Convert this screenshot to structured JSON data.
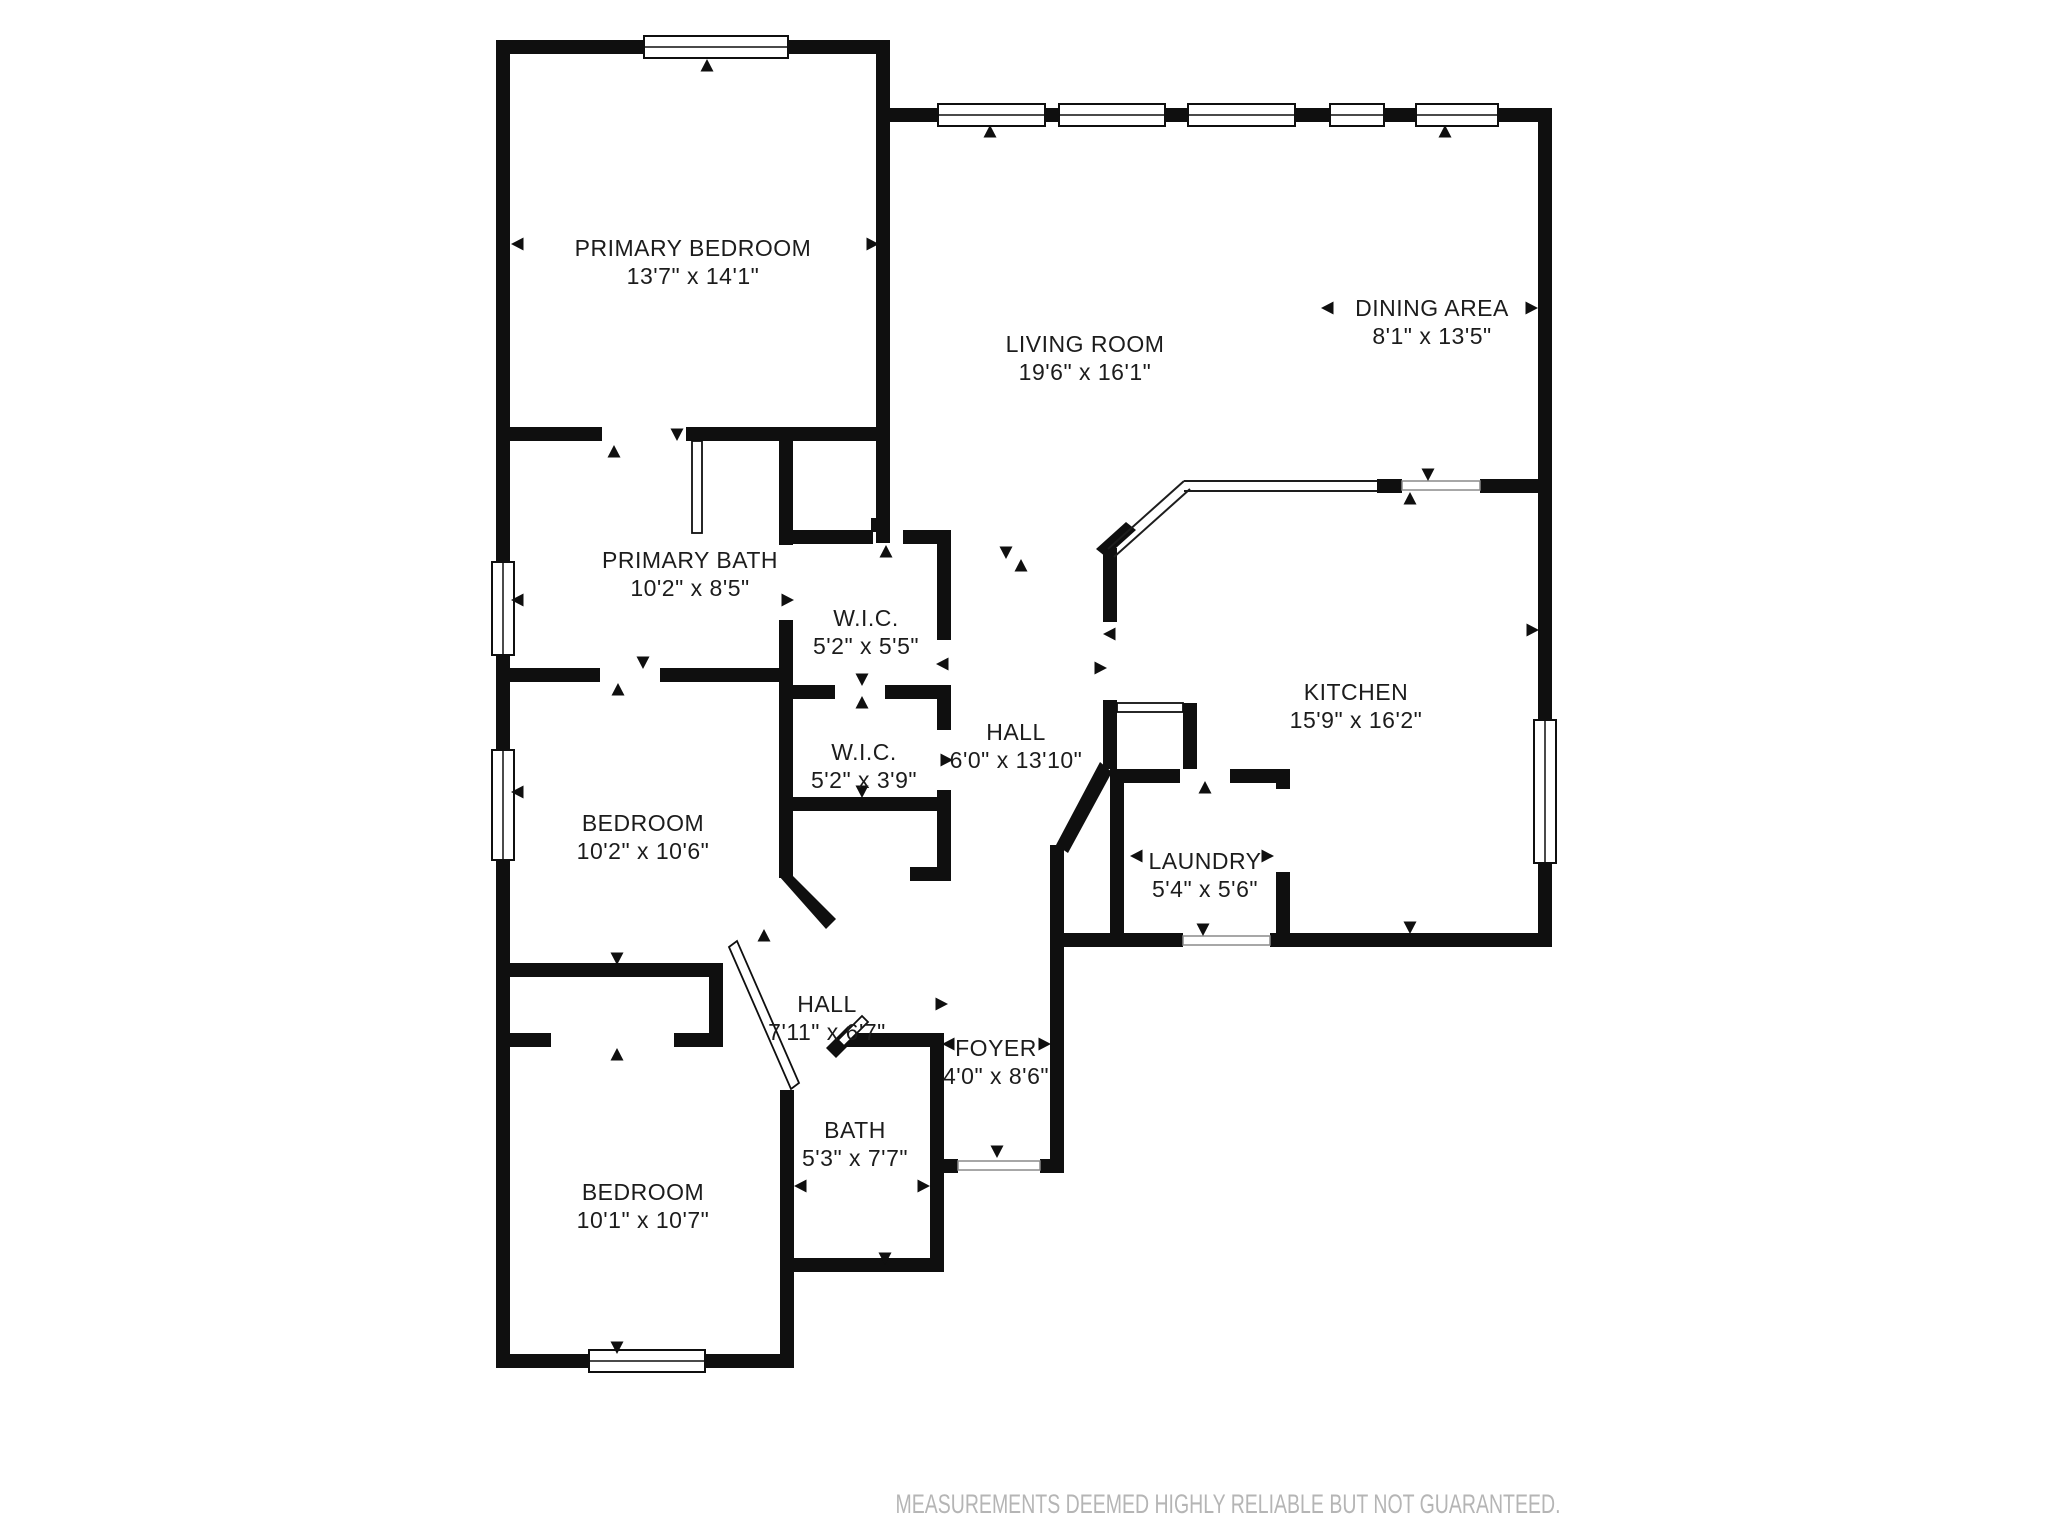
{
  "colors": {
    "wall": "#0f0f0f",
    "label": "#1c1c1c",
    "disclaimer": "#b5b5b5",
    "background": "#ffffff"
  },
  "rooms": [
    {
      "name": "PRIMARY BEDROOM",
      "dims": "13'7\" x 14'1\""
    },
    {
      "name": "LIVING ROOM",
      "dims": "19'6\" x 16'1\""
    },
    {
      "name": "DINING AREA",
      "dims": "8'1\" x 13'5\""
    },
    {
      "name": "PRIMARY BATH",
      "dims": "10'2\" x 8'5\""
    },
    {
      "name": "W.I.C.",
      "dims": "5'2\" x 5'5\""
    },
    {
      "name": "W.I.C.",
      "dims": "5'2\" x 3'9\""
    },
    {
      "name": "HALL",
      "dims": "6'0\" x 13'10\""
    },
    {
      "name": "KITCHEN",
      "dims": "15'9\" x 16'2\""
    },
    {
      "name": "LAUNDRY",
      "dims": "5'4\" x 5'6\""
    },
    {
      "name": "BEDROOM",
      "dims": "10'2\" x 10'6\""
    },
    {
      "name": "HALL",
      "dims": "7'11\" x 6'7\""
    },
    {
      "name": "FOYER",
      "dims": "4'0\" x 8'6\""
    },
    {
      "name": "BATH",
      "dims": "5'3\" x 7'7\""
    },
    {
      "name": "BEDROOM",
      "dims": "10'1\" x 10'7\""
    }
  ],
  "footer": {
    "disclaimer": "MEASUREMENTS DEEMED HIGHLY RELIABLE BUT NOT GUARANTEED."
  }
}
